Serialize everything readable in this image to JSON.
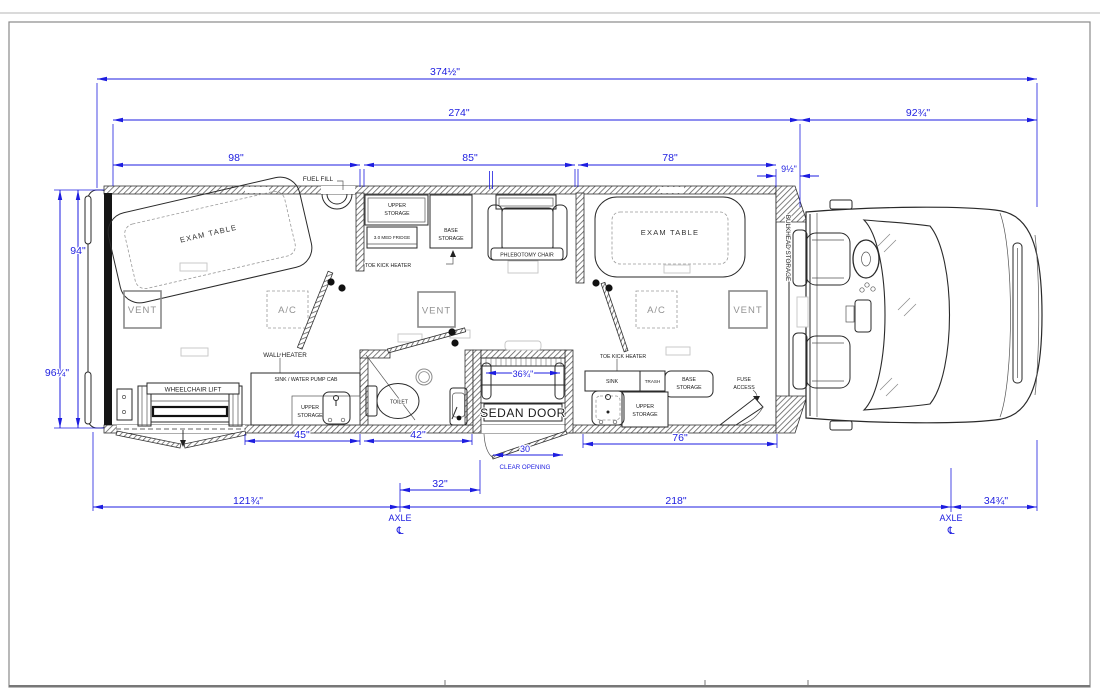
{
  "sheet": {
    "type": "floor-plan-drawing",
    "subject": "mobile medical vehicle top-view floor plan"
  },
  "colors": {
    "dimension_blue": "#1d1de0",
    "linework": "#2a2a2a",
    "hatch_gray": "#606060",
    "light_gray": "#c5c5c5"
  },
  "dims": {
    "overall": "374½\"",
    "body_interior": "274\"",
    "cab_length": "92¾\"",
    "rear_room": "98\"",
    "mid_room": "85\"",
    "front_room": "78\"",
    "bulkhead_gap": "9½\"",
    "interior_width": "94\"",
    "overall_width": "96¼\"",
    "rear_counter": "45\"",
    "bath": "42\"",
    "front_counter": "76\"",
    "step_width": "36¾\"",
    "clear_opening": "30",
    "clear_opening_label": "CLEAR OPENING",
    "axle_to_door": "32\"",
    "rear_overhang": "121¾\"",
    "wheelbase": "218\"",
    "front_overhang": "34¾\"",
    "axle_label": "AXLE",
    "centerline_symbol": "℄"
  },
  "labels": {
    "fuel_fill": "FUEL FILL",
    "exam_table": "EXAM TABLE",
    "vent": "VENT",
    "ac": "A/C",
    "wall_heater": "WALL HEATER",
    "sink_water_pump_cab": "SINK / WATER PUMP CAB",
    "wheelchair_lift": "WHEELCHAIR LIFT",
    "upper": "UPPER",
    "storage": "STORAGE",
    "base": "BASE",
    "med_fridge": "3.0 MED FRIDGE",
    "toe_kick_heater": "TOE KICK HEATER",
    "phlebotomy_chair": "PHLEBOTOMY CHAIR",
    "toilet": "TOILET",
    "sedan_door": "SEDAN DOOR",
    "sink": "SINK",
    "trash": "TRASH",
    "fuse": "FUSE",
    "access": "ACCESS",
    "bulkhead_storage": "BULKHEAD STORAGE"
  }
}
